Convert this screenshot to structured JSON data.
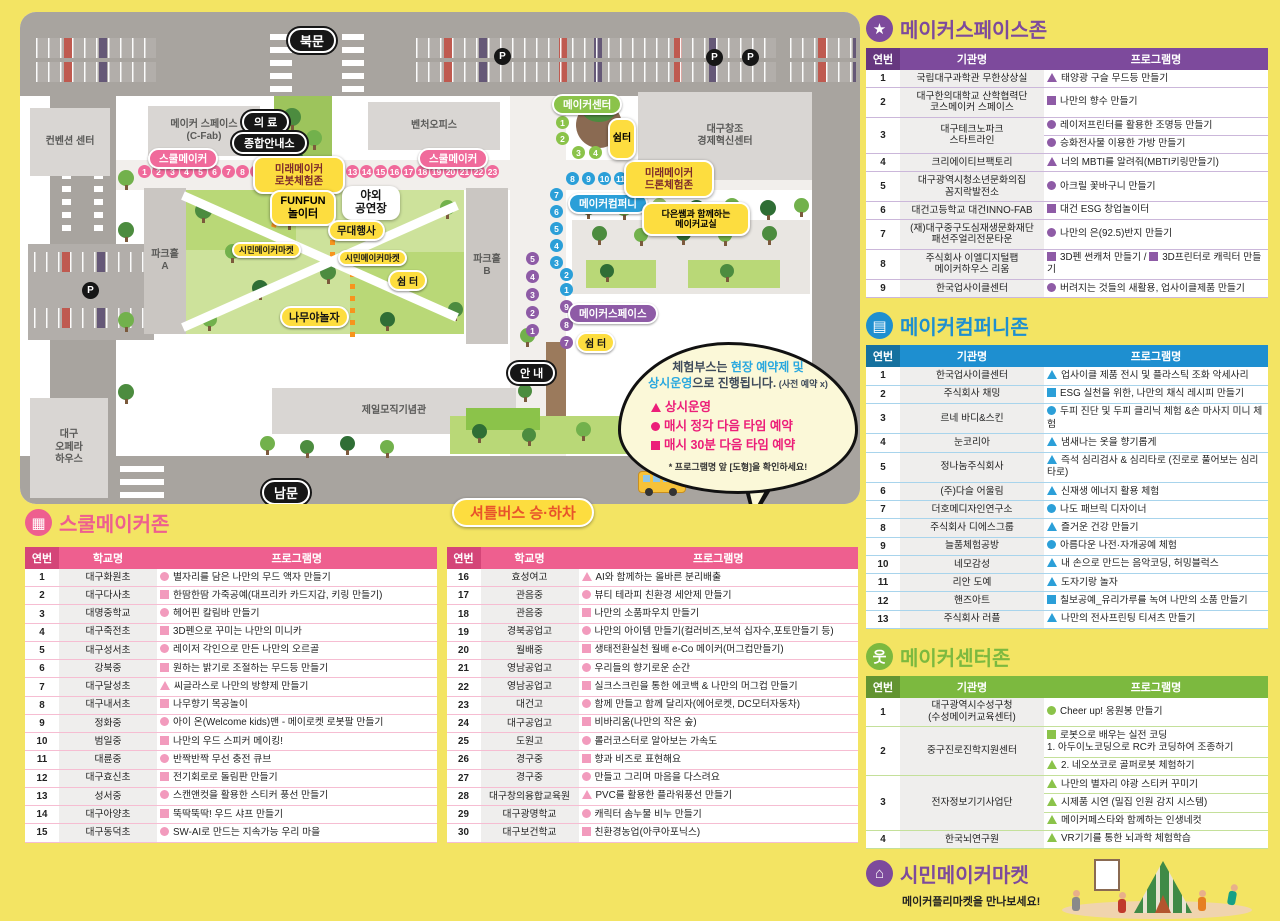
{
  "map": {
    "labels": {
      "north_gate": "북문",
      "south_gate": "남문",
      "info": "안 내",
      "medical": "의 료",
      "info_center": "종합안내소",
      "school_maker": "스쿨메이커",
      "robot_zone": "미래메이커\n로봇체험존",
      "drone_zone": "미래메이커\n드론체험존",
      "funfun": "FUNFUN\n놀이터",
      "outdoor_stage": "야외\n공연장",
      "stage_event": "무대행사",
      "citizen_market": "시민메이커마켓",
      "rest_area": "쉼 터",
      "rest_area_v": "쉼터",
      "namu_playground": "나무야놀자",
      "maker_center": "메이커센터",
      "maker_company": "메이커컴퍼니",
      "maker_space": "메이커스페이스",
      "daeun_class": "다은쌤과 함께하는\n메이커교실",
      "shuttle_stop": "셔틀버스 승·하차",
      "shuttle_small": "셔틀버스",
      "bld_cfab": "메이커 스페이스\n(C-Fab)",
      "bld_venture": "벤처오피스",
      "bld_dg_center": "대구창조\n경제혁신센터",
      "bld_convention": "컨벤션 센터",
      "bld_opera": "대구\n오페라\n하우스",
      "bld_cheil": "제일모직기념관",
      "parkhall_a": "파크홀\nA",
      "parkhall_b": "파크홀\nB",
      "p_marker": "P"
    },
    "booths": {
      "pink_left": [
        "1",
        "2",
        "3",
        "4",
        "5",
        "6",
        "7",
        "8",
        "9",
        "10",
        "11",
        "12"
      ],
      "pink_right": [
        "13",
        "14",
        "15",
        "16",
        "17",
        "18",
        "19",
        "20",
        "21",
        "22",
        "23"
      ],
      "green_v": [
        "1",
        "2"
      ],
      "green_h": [
        "3",
        "4"
      ],
      "blue_h": [
        "8",
        "9",
        "10",
        "11",
        "12",
        "13"
      ],
      "blue_v": [
        "7",
        "6",
        "5",
        "4",
        "3"
      ],
      "blue_v2": [
        "2",
        "1"
      ],
      "purple_v_left": [
        "5",
        "4",
        "3",
        "2",
        "1"
      ],
      "purple_v_right": [
        "9",
        "8",
        "7"
      ]
    },
    "bubble": {
      "line1_a": "체험부스는 ",
      "line1_b": "현장 예약제 및",
      "line2_a": "상시운영",
      "line2_b": "으로 진행됩니다.",
      "line2_c": " (사전 예약 x)",
      "items": [
        {
          "shape": "tri",
          "text": "상시운영"
        },
        {
          "shape": "c",
          "text": "매시 정각 다음 타임 예약"
        },
        {
          "shape": "sq",
          "text": "매시 30분 다음 타임 예약"
        }
      ],
      "note": "* 프로그램명 앞 [도형]을 확인하세요!"
    }
  },
  "sections": [
    {
      "id": "makerspace",
      "title": "메이커스페이스존",
      "icon": "star-icon",
      "glyph": "★",
      "color": "#7d4a9c",
      "color_dark": "#66377f",
      "sep": "#cbb7da",
      "bullet": "#8e5ba6",
      "headers": [
        "연번",
        "기관명",
        "프로그램명"
      ],
      "rows": [
        {
          "num": "1",
          "name": "국립대구과학관 무한상상실",
          "lines": [
            [
              {
                "s": "tri",
                "t": "태양광 구슬 무드등 만들기"
              }
            ]
          ]
        },
        {
          "num": "2",
          "name": "대구한의대학교 산학협력단\n코스메이커 스페이스",
          "lines": [
            [
              {
                "s": "sq",
                "t": "나만의 향수 만들기"
              }
            ]
          ]
        },
        {
          "num": "3",
          "name": "대구테크노파크\n스타트라인",
          "lines": [
            [
              {
                "s": "c",
                "t": "레이저프린터를 활용한 조명등 만들기"
              }
            ],
            [
              {
                "s": "c",
                "t": "승화전사물 이용한 가방 만들기"
              }
            ]
          ]
        },
        {
          "num": "4",
          "name": "크리에이티브팩토리",
          "lines": [
            [
              {
                "s": "tri",
                "t": "너의 MBTI를 알려줘(MBTI키링만들기)"
              }
            ]
          ]
        },
        {
          "num": "5",
          "name": "대구광역시청소년문화의집\n꼼지락발전소",
          "lines": [
            [
              {
                "s": "c",
                "t": "아크릴 꽃바구니 만들기"
              }
            ]
          ]
        },
        {
          "num": "6",
          "name": "대건고등학교 대건INNO-FAB",
          "lines": [
            [
              {
                "s": "sq",
                "t": "대건 ESG 창업놀이터"
              }
            ]
          ]
        },
        {
          "num": "7",
          "name": "(재)대구중구도심재생문화재단\n패션주얼리전문타운",
          "lines": [
            [
              {
                "s": "c",
                "t": "나만의 은(92.5)반지 만들기"
              }
            ]
          ]
        },
        {
          "num": "8",
          "name": "주식회사 이엘디지털팹\n메이커하우스 리움",
          "lines": [
            [
              {
                "s": "sq",
                "t": "3D펜 썬캐처 만들기 / "
              },
              {
                "s": "sq",
                "t": "3D프린터로 캐릭터 만들기"
              }
            ]
          ]
        },
        {
          "num": "9",
          "name": "한국업사이클센터",
          "lines": [
            [
              {
                "s": "c",
                "t": "버려지는 것들의 새활용, 업사이클제품 만들기"
              }
            ]
          ]
        }
      ]
    },
    {
      "id": "company",
      "title": "메이커컴퍼니존",
      "icon": "company-icon",
      "glyph": "▤",
      "color": "#1e8fd0",
      "color_dark": "#15719f",
      "sep": "#a8d4ec",
      "bullet": "#2b9fd8",
      "headers": [
        "연번",
        "기관명",
        "프로그램명"
      ],
      "rows": [
        {
          "num": "1",
          "name": "한국업사이클센터",
          "lines": [
            [
              {
                "s": "tri",
                "t": "업사이클 제품 전시 및 플라스틱 조화 악세사리"
              }
            ]
          ]
        },
        {
          "num": "2",
          "name": "주식회사 채밍",
          "lines": [
            [
              {
                "s": "sq",
                "t": "ESG 실천을 위한, 나만의 채식 레시피 만들기"
              }
            ]
          ]
        },
        {
          "num": "3",
          "name": "르네 바디&스킨",
          "lines": [
            [
              {
                "s": "c",
                "t": "두피 진단 및 두피 클리닉 체험 &손 마사지 미니 체험"
              }
            ]
          ]
        },
        {
          "num": "4",
          "name": "눈코리아",
          "lines": [
            [
              {
                "s": "tri",
                "t": "냄새나는 옷을 향기롭게"
              }
            ]
          ]
        },
        {
          "num": "5",
          "name": "정나눔주식회사",
          "lines": [
            [
              {
                "s": "tri",
                "t": "즉석 심리검사 & 심리타로 (진로로 풀어보는 심리타로)"
              }
            ]
          ]
        },
        {
          "num": "6",
          "name": "(주)다슬 어울림",
          "lines": [
            [
              {
                "s": "tri",
                "t": "신재생 에너지 활용 체험"
              }
            ]
          ]
        },
        {
          "num": "7",
          "name": "더호메디자인연구소",
          "lines": [
            [
              {
                "s": "c",
                "t": "나도 패브릭 디자이너"
              }
            ]
          ]
        },
        {
          "num": "8",
          "name": "주식회사 디에스그룹",
          "lines": [
            [
              {
                "s": "tri",
                "t": "즐거운 건강 만들기"
              }
            ]
          ]
        },
        {
          "num": "9",
          "name": "늘품체험공방",
          "lines": [
            [
              {
                "s": "c",
                "t": "아름다운 나전·자개공예 체험"
              }
            ]
          ]
        },
        {
          "num": "10",
          "name": "네모감성",
          "lines": [
            [
              {
                "s": "tri",
                "t": "내 손으로 만드는 음악코딩, 허밍블럭스"
              }
            ]
          ]
        },
        {
          "num": "11",
          "name": "리안 도예",
          "lines": [
            [
              {
                "s": "tri",
                "t": "도자기랑 놀자"
              }
            ]
          ]
        },
        {
          "num": "12",
          "name": "핸즈아트",
          "lines": [
            [
              {
                "s": "sq",
                "t": "칠보공예_유리가루를 녹여 나만의 소품 만들기"
              }
            ]
          ]
        },
        {
          "num": "13",
          "name": "주식회사 러플",
          "lines": [
            [
              {
                "s": "tri",
                "t": "나만의 전사프린팅 티셔츠 만들기"
              }
            ]
          ]
        }
      ]
    },
    {
      "id": "center",
      "title": "메이커센터존",
      "icon": "person-icon",
      "glyph": "웃",
      "color": "#7cb93f",
      "color_dark": "#629431",
      "sep": "#c4e09a",
      "bullet": "#8bc34a",
      "headers": [
        "연번",
        "기관명",
        "프로그램명"
      ],
      "rows": [
        {
          "num": "1",
          "name": "대구광역시수성구청\n(수성메이커교육센터)",
          "lines": [
            [
              {
                "s": "c",
                "t": "Cheer up! 응원봉 만들기"
              }
            ]
          ]
        },
        {
          "num": "2",
          "name": "중구진로진학지원센터",
          "lines": [
            [
              {
                "s": "sq",
                "t": "로봇으로 배우는 실전 코딩\n1. 아두이노코딩으로 RC카 코딩하여 조종하기"
              }
            ],
            [
              {
                "s": "tri",
                "t": "2. 네오쏘코로 골퍼로봇 체험하기"
              }
            ]
          ]
        },
        {
          "num": "3",
          "name": "전자정보기기사업단",
          "lines": [
            [
              {
                "s": "tri",
                "t": "나만의 별자리 야광 스티커 꾸미기"
              }
            ],
            [
              {
                "s": "tri",
                "t": "시제품 시연 (밀집 인원 감지 시스템)"
              }
            ],
            [
              {
                "s": "tri",
                "t": "메이커페스타와 함께하는 인생네컷"
              }
            ]
          ]
        },
        {
          "num": "4",
          "name": "한국뇌연구원",
          "lines": [
            [
              {
                "s": "tri",
                "t": "VR기기를 통한 뇌과학 체험학습"
              }
            ]
          ]
        }
      ]
    }
  ],
  "school": {
    "title": "스쿨메이커존",
    "icon": "school-icon",
    "glyph": "▦",
    "color": "#ee5f8f",
    "color_dark": "#d44578",
    "sep": "#f6bdd2",
    "bullet": "#f29bbd",
    "headers": [
      "연번",
      "학교명",
      "프로그램명"
    ],
    "rows_left": [
      {
        "num": "1",
        "name": "대구화원초",
        "lines": [
          [
            {
              "s": "c",
              "t": "별자리를 담은 나만의 무드 액자 만들기"
            }
          ]
        ]
      },
      {
        "num": "2",
        "name": "대구다사초",
        "lines": [
          [
            {
              "s": "sq",
              "t": "한땀한땀 가죽공예(대프리카 카드지갑, 키링 만들기)"
            }
          ]
        ]
      },
      {
        "num": "3",
        "name": "대명중학교",
        "lines": [
          [
            {
              "s": "c",
              "t": "헤어핀 칼림바 만들기"
            }
          ]
        ]
      },
      {
        "num": "4",
        "name": "대구죽전초",
        "lines": [
          [
            {
              "s": "sq",
              "t": "3D펜으로 꾸미는 나만의 미니카"
            }
          ]
        ]
      },
      {
        "num": "5",
        "name": "대구성서초",
        "lines": [
          [
            {
              "s": "c",
              "t": "레이저 각인으로 만든 나만의 오르골"
            }
          ]
        ]
      },
      {
        "num": "6",
        "name": "강북중",
        "lines": [
          [
            {
              "s": "sq",
              "t": "원하는 밝기로 조절하는 무드등 만들기"
            }
          ]
        ]
      },
      {
        "num": "7",
        "name": "대구달성초",
        "lines": [
          [
            {
              "s": "tri",
              "t": "씨글라스로 나만의 방향제 만들기"
            }
          ]
        ]
      },
      {
        "num": "8",
        "name": "대구내서초",
        "lines": [
          [
            {
              "s": "sq",
              "t": "나무향기 목공놀이"
            }
          ]
        ]
      },
      {
        "num": "9",
        "name": "정화중",
        "lines": [
          [
            {
              "s": "c",
              "t": "아이 온(Welcome kids)맨 - 메이로켓 로봇팔 만들기"
            }
          ]
        ]
      },
      {
        "num": "10",
        "name": "범일중",
        "lines": [
          [
            {
              "s": "sq",
              "t": "나만의 우드 스피커 메이킹!"
            }
          ]
        ]
      },
      {
        "num": "11",
        "name": "대륜중",
        "lines": [
          [
            {
              "s": "c",
              "t": "반짝반짝 무선 충전 큐브"
            }
          ]
        ]
      },
      {
        "num": "12",
        "name": "대구효신초",
        "lines": [
          [
            {
              "s": "sq",
              "t": "전기회로로 돌림판 만들기"
            }
          ]
        ]
      },
      {
        "num": "13",
        "name": "성서중",
        "lines": [
          [
            {
              "s": "c",
              "t": "스캔앤컷을 활용한 스티커 풍선 만들기"
            }
          ]
        ]
      },
      {
        "num": "14",
        "name": "대구아양초",
        "lines": [
          [
            {
              "s": "sq",
              "t": "뚝딱뚝딱! 우드 샤프 만들기"
            }
          ]
        ]
      },
      {
        "num": "15",
        "name": "대구동덕초",
        "lines": [
          [
            {
              "s": "c",
              "t": "SW-AI로 만드는 지속가능 우리 마을"
            }
          ]
        ]
      }
    ],
    "rows_right": [
      {
        "num": "16",
        "name": "효성여고",
        "lines": [
          [
            {
              "s": "tri",
              "t": "AI와 함께하는 올바른 분리배출"
            }
          ]
        ]
      },
      {
        "num": "17",
        "name": "관음중",
        "lines": [
          [
            {
              "s": "c",
              "t": "뷰티 테라피 친환경 세안제 만들기"
            }
          ]
        ]
      },
      {
        "num": "18",
        "name": "관음중",
        "lines": [
          [
            {
              "s": "sq",
              "t": "나만의 소품파우치 만들기"
            }
          ]
        ]
      },
      {
        "num": "19",
        "name": "경북공업고",
        "lines": [
          [
            {
              "s": "c",
              "t": "나만의 아이템 만들기(컬러비즈,보석 십자수,포토만들기 등)"
            }
          ]
        ]
      },
      {
        "num": "20",
        "name": "월배중",
        "lines": [
          [
            {
              "s": "sq",
              "t": "생태전환실천 월배 e-Co 메이커(머그컵만들기)"
            }
          ]
        ]
      },
      {
        "num": "21",
        "name": "영남공업고",
        "lines": [
          [
            {
              "s": "c",
              "t": "우리들의 향기로운 순간"
            }
          ]
        ]
      },
      {
        "num": "22",
        "name": "영남공업고",
        "lines": [
          [
            {
              "s": "sq",
              "t": "실크스크린을 통한 에코백 & 나만의 머그컵 만들기"
            }
          ]
        ]
      },
      {
        "num": "23",
        "name": "대건고",
        "lines": [
          [
            {
              "s": "c",
              "t": "함께 만들고 함께 달리자(에어로켓, DC모터자동차)"
            }
          ]
        ]
      },
      {
        "num": "24",
        "name": "대구공업고",
        "lines": [
          [
            {
              "s": "sq",
              "t": "비바리움(나만의 작은 숲)"
            }
          ]
        ]
      },
      {
        "num": "25",
        "name": "도원고",
        "lines": [
          [
            {
              "s": "c",
              "t": "롤러코스터로 알아보는 가속도"
            }
          ]
        ]
      },
      {
        "num": "26",
        "name": "경구중",
        "lines": [
          [
            {
              "s": "sq",
              "t": "향과 비즈로 표현해요"
            }
          ]
        ]
      },
      {
        "num": "27",
        "name": "경구중",
        "lines": [
          [
            {
              "s": "c",
              "t": "만들고 그리며 마음을 다스려요"
            }
          ]
        ]
      },
      {
        "num": "28",
        "name": "대구창의융합교육원",
        "lines": [
          [
            {
              "s": "tri",
              "t": "PVC를 활용한 플라워풍선 만들기"
            }
          ]
        ]
      },
      {
        "num": "29",
        "name": "대구광명학교",
        "lines": [
          [
            {
              "s": "c",
              "t": "캐릭터 솜누물 비누 만들기"
            }
          ]
        ]
      },
      {
        "num": "30",
        "name": "대구보건학교",
        "lines": [
          [
            {
              "s": "sq",
              "t": "친환경농업(아쿠아포닉스)"
            }
          ]
        ]
      }
    ]
  },
  "market": {
    "title": "시민메이커마켓",
    "icon": "market-icon",
    "glyph": "⌂",
    "color": "#7d4a9c",
    "subtitle": "메이커플리마켓을 만나보세요!"
  }
}
